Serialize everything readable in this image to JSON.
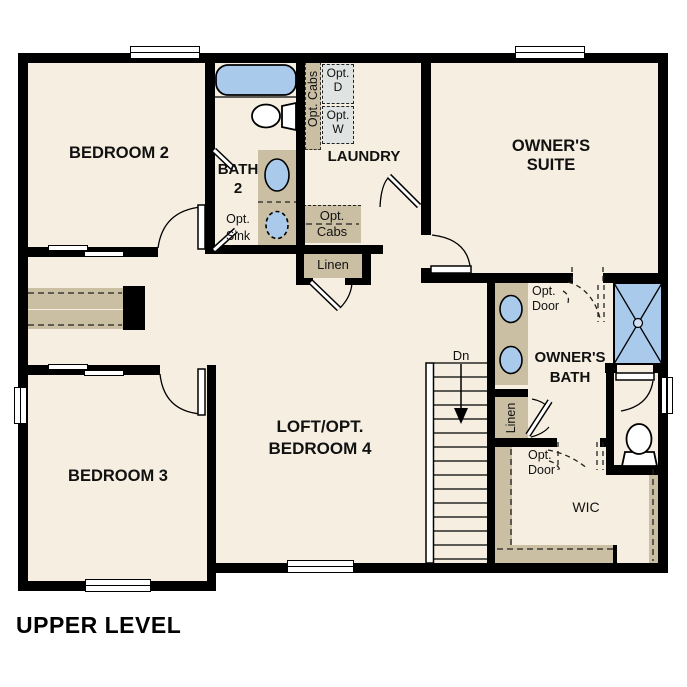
{
  "plan": {
    "title": "UPPER LEVEL",
    "rooms": {
      "bedroom2": "BEDROOM 2",
      "bedroom3": "BEDROOM 3",
      "owners_suite_l1": "OWNER'S",
      "owners_suite_l2": "SUITE",
      "laundry": "LAUNDRY",
      "bath2_l1": "BATH",
      "bath2_l2": "2",
      "loft_l1": "LOFT/OPT.",
      "loft_l2": "BEDROOM 4",
      "owners_bath_l1": "OWNER'S",
      "owners_bath_l2": "BATH",
      "wic": "WIC"
    },
    "labels": {
      "opt_sink_l1": "Opt.",
      "opt_sink_l2": "Sink",
      "opt_cabs_vertical": "Opt. Cabs",
      "opt_d_l1": "Opt.",
      "opt_d_l2": "D",
      "opt_w_l1": "Opt.",
      "opt_w_l2": "W",
      "opt_cabs_l1": "Opt.",
      "opt_cabs_l2": "Cabs",
      "linen_hall": "Linen",
      "linen_bath": "Linen",
      "opt_door_bath_l1": "Opt.",
      "opt_door_bath_l2": "Door",
      "opt_door_wic_l1": "Opt.",
      "opt_door_wic_l2": "Door",
      "down": "Dn"
    },
    "colors": {
      "floor": "#f6efe1",
      "wall": "#000000",
      "cabinet": "#cbbfa3",
      "fixture_blue": "#aacaec",
      "appliance_gray": "#dfe3e2"
    }
  }
}
